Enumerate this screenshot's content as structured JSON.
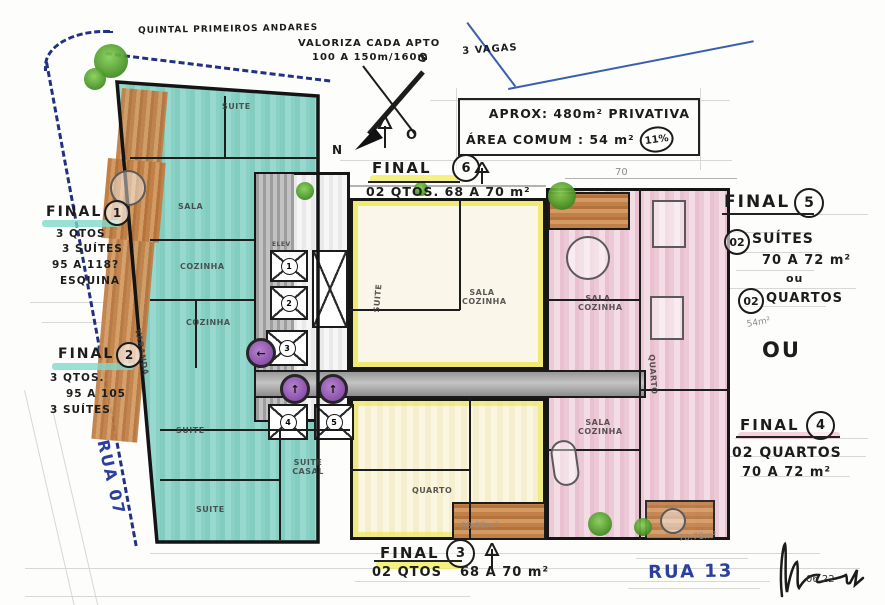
{
  "notes": {
    "corner": "QUINTAL PRIMEIROS ANDARES",
    "valoriza1": "VALORIZA CADA APTO",
    "valoriza2": "100 A 150m/160m",
    "vagas": "3 VAGAS",
    "dim70": "70",
    "m6868": "68.68m²",
    "m7070": "70.70m²",
    "m54": "54m²",
    "date": "06.22"
  },
  "area_box": {
    "line1": "APROX: 480m² PRIVATIVA",
    "line2": "ÁREA COMUM : 54 m²",
    "badge": "11%"
  },
  "compass": {
    "n": "N",
    "s": "S",
    "o": "O"
  },
  "finals": {
    "f1": {
      "title": "FINAL",
      "num": "1",
      "l1": "3 QTOS",
      "l2": "3 SUÍTES",
      "l3": "95 A 118?",
      "l4": "ESQUINA"
    },
    "f2": {
      "title": "FINAL",
      "num": "2",
      "l1": "3 QTOS.",
      "l2": "95 A 105",
      "l3": "3 SUÍTES"
    },
    "f3": {
      "title": "FINAL",
      "num": "3",
      "l1": "02 QTOS",
      "l2": "68 A 70 m²"
    },
    "f4": {
      "title": "FINAL",
      "num": "4",
      "l1": "02 QUARTOS",
      "l2": "70 A 72 m²"
    },
    "f5": {
      "title": "FINAL",
      "num": "5",
      "q1": "02",
      "l1": "SUÍTES",
      "l2": "70 A 72 m²",
      "or": "ou",
      "q2": "02",
      "l3": "QUARTOS"
    },
    "f6": {
      "title": "FINAL",
      "num": "6",
      "l1": "02 QTOS. 68 A 70 m²"
    }
  },
  "or_big": "OU",
  "streets": {
    "rua07": "RUA 07",
    "rua13": "RUA 13"
  },
  "rooms": {
    "sala": "SALA",
    "cozinha": "COZINHA",
    "suite": "SUITE",
    "suite_casal": "SUITE CASAL",
    "varanda": "VARANDA",
    "sala_cozinha": "SALA COZINHA",
    "quarto": "QUARTO",
    "elev": "ELEV"
  },
  "elevators": {
    "n1": "1",
    "n2": "2",
    "n3": "3",
    "n4": "4",
    "n5": "5"
  }
}
